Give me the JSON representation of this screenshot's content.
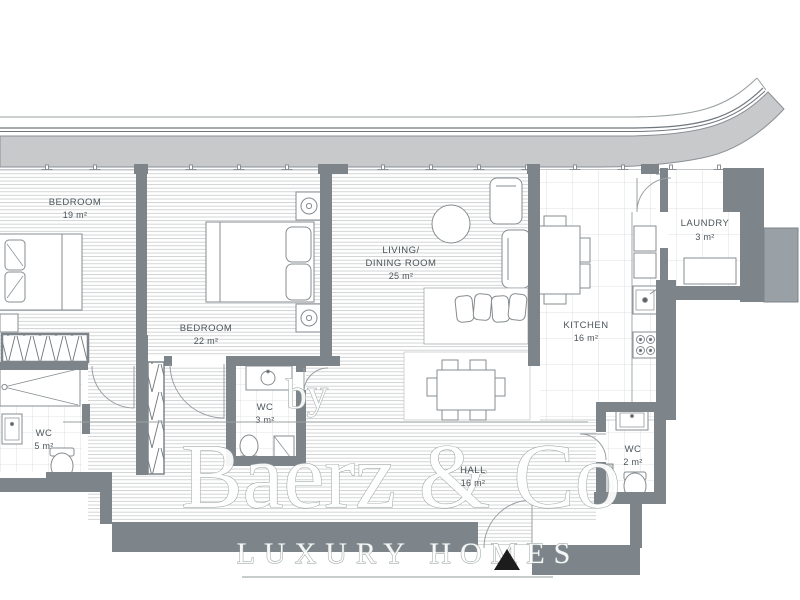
{
  "plan": {
    "rooms": {
      "bedroom1": {
        "name": "BEDROOM",
        "area": "19 m²"
      },
      "bedroom2": {
        "name": "BEDROOM",
        "area": "22 m²"
      },
      "living": {
        "name_line1": "LIVING/",
        "name_line2": "DINING ROOM",
        "area": "25 m²"
      },
      "kitchen": {
        "name": "KITCHEN",
        "area": "16 m²"
      },
      "laundry": {
        "name": "LAUNDRY",
        "area": "3 m²"
      },
      "wc_main": {
        "name": "WC",
        "area": "5 m²"
      },
      "wc_middle": {
        "name": "WC",
        "area": "3 m²"
      },
      "wc_guest": {
        "name": "WC",
        "area": "2 m²"
      },
      "hall": {
        "name": "HALL",
        "area": "16 m²"
      }
    }
  },
  "watermark": {
    "prefix": "by",
    "brand": "Baerz & Co",
    "tagline": "LUXURY HOMES"
  },
  "colors": {
    "wall": "#7d858b",
    "balcony_band": "#c7c9cb",
    "floor_line": "#c9cbcc",
    "label": "#4b5559",
    "entrance_marker": "#1c1c1c"
  }
}
